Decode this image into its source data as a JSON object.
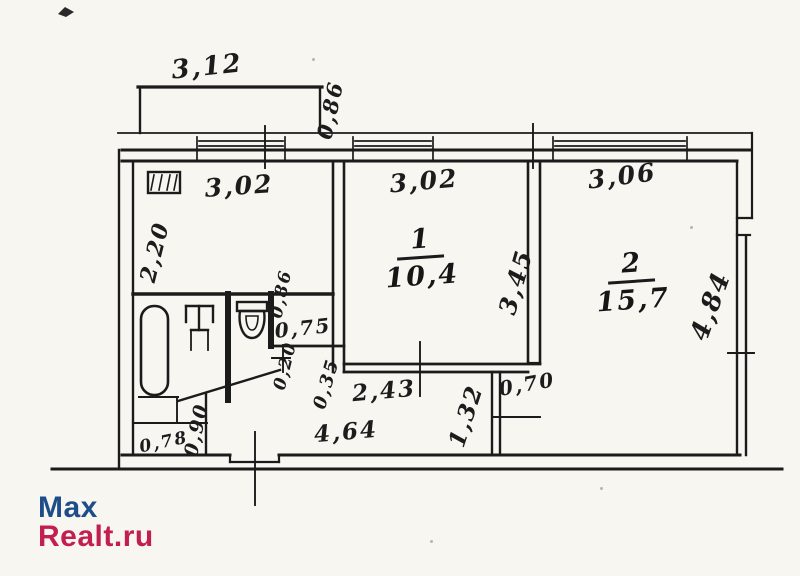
{
  "watermark": {
    "brand_top": "Max",
    "brand_bottom": "Realt.ru",
    "color_top": "#1d4e8a",
    "color_bottom": "#c31e50"
  },
  "rooms": {
    "room1": {
      "number": "1",
      "area": "10,4"
    },
    "room2": {
      "number": "2",
      "area": "15,7"
    }
  },
  "dims": {
    "balcony_width": "3,12",
    "balcony_depth": "0,86",
    "kitchen_width": "3,02",
    "kitchen_depth": "2,20",
    "room1_width": "3,02",
    "room1_depth": "3,45",
    "room1_bottom": "2,43",
    "room2_width": "3,06",
    "room2_height": "4,84",
    "alcove_width": "0,75",
    "alcove_depth": "0,86",
    "small_020": "0,20",
    "small_035": "0,35",
    "door_070": "0,70",
    "wall_132": "1,32",
    "hall_464": "4,64",
    "nook_090": "0,90",
    "nook_078": "0,78"
  },
  "icons": {
    "stove": "stove-icon",
    "bathtub": "bathtub-icon",
    "sink": "sink-icon",
    "toilet": "toilet-icon"
  },
  "ink_color": "#1b1b1b"
}
